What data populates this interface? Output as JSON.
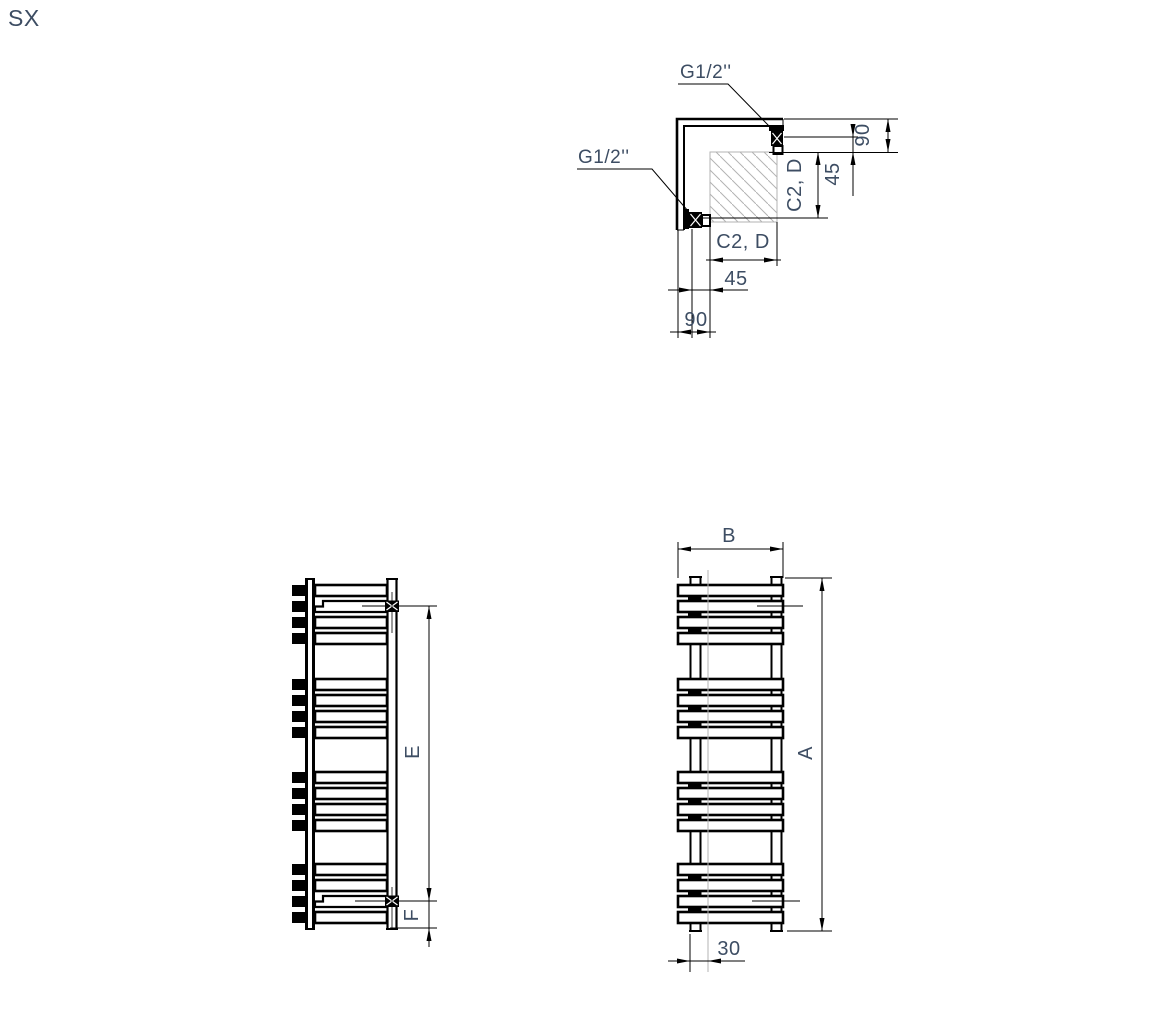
{
  "page": {
    "orientation_label": "SX"
  },
  "corner_detail": {
    "thread_top": "G1/2''",
    "thread_side": "G1/2''",
    "dim_offset_vertical": "90",
    "dim_half_offset_vertical": "45",
    "dim_center_vertical": "C2, D",
    "dim_center_horizontal": "C2, D",
    "dim_half_offset_horizontal": "45",
    "dim_offset_horizontal": "90"
  },
  "side_view": {
    "dim_connection_spacing": "E",
    "dim_bottom_offset": "F"
  },
  "front_view": {
    "dim_width": "B",
    "dim_height": "A",
    "dim_axis_offset": "30"
  },
  "colors": {
    "line": "#000000",
    "label": "#3d4d63",
    "hatch": "#b3b3b3"
  }
}
